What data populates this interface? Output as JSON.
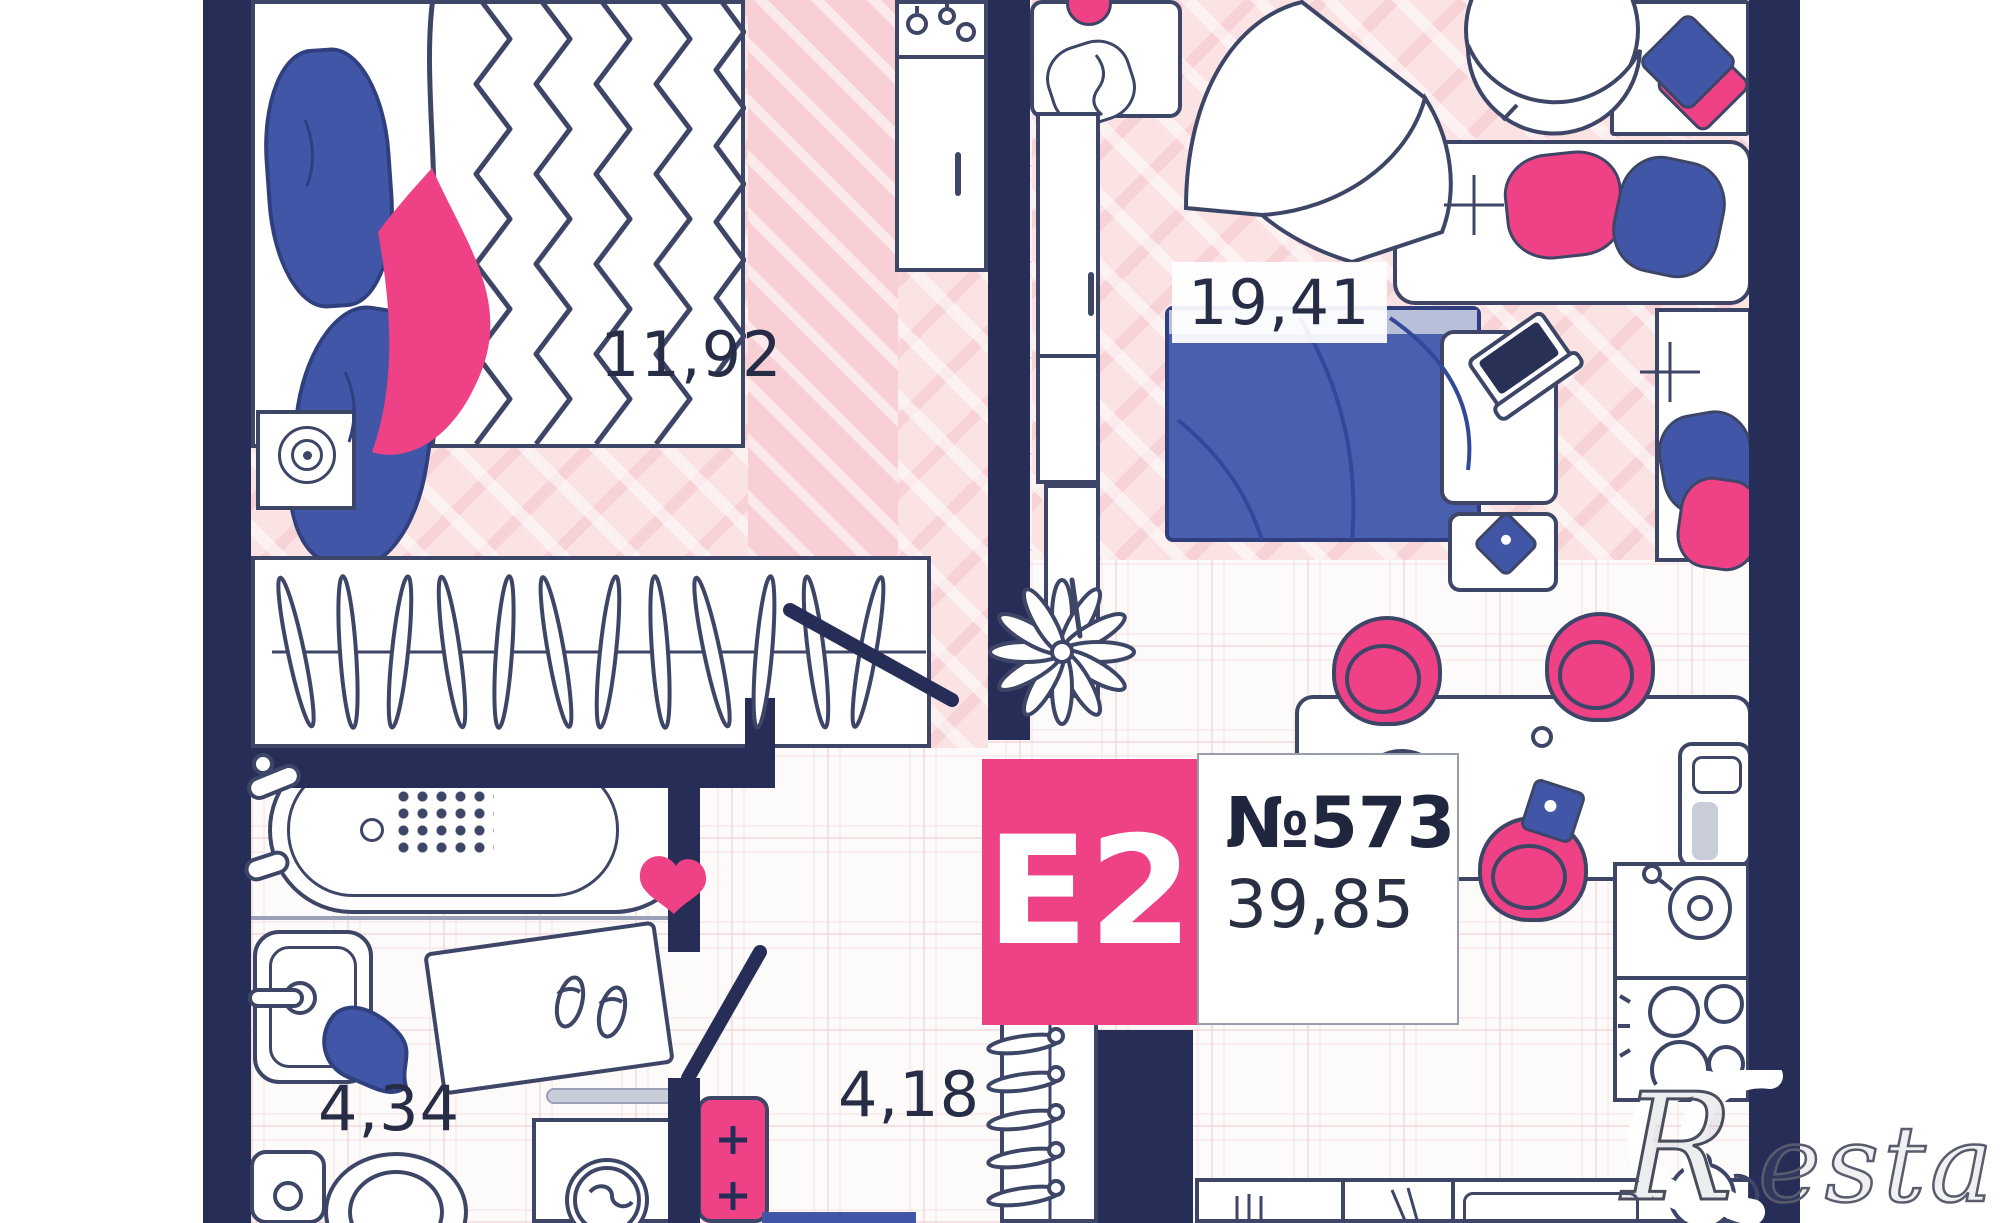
{
  "plan": {
    "unit": {
      "type_label": "E2",
      "number": "№573",
      "total_area": "39,85"
    },
    "rooms": [
      {
        "name": "bedroom",
        "area": "11,92"
      },
      {
        "name": "living-room",
        "area": "19,41"
      },
      {
        "name": "bathroom",
        "area": "4,34"
      },
      {
        "name": "hallway",
        "area": "4,18"
      }
    ],
    "watermark": {
      "initial": "R",
      "suffix": "estate"
    },
    "colors": {
      "wall_navy": "#262e57",
      "accent_pink": "#ee4186",
      "furniture_blue": "#4156a6",
      "floor_pink": "#fbe2e3",
      "outline": "#3e4668"
    }
  }
}
